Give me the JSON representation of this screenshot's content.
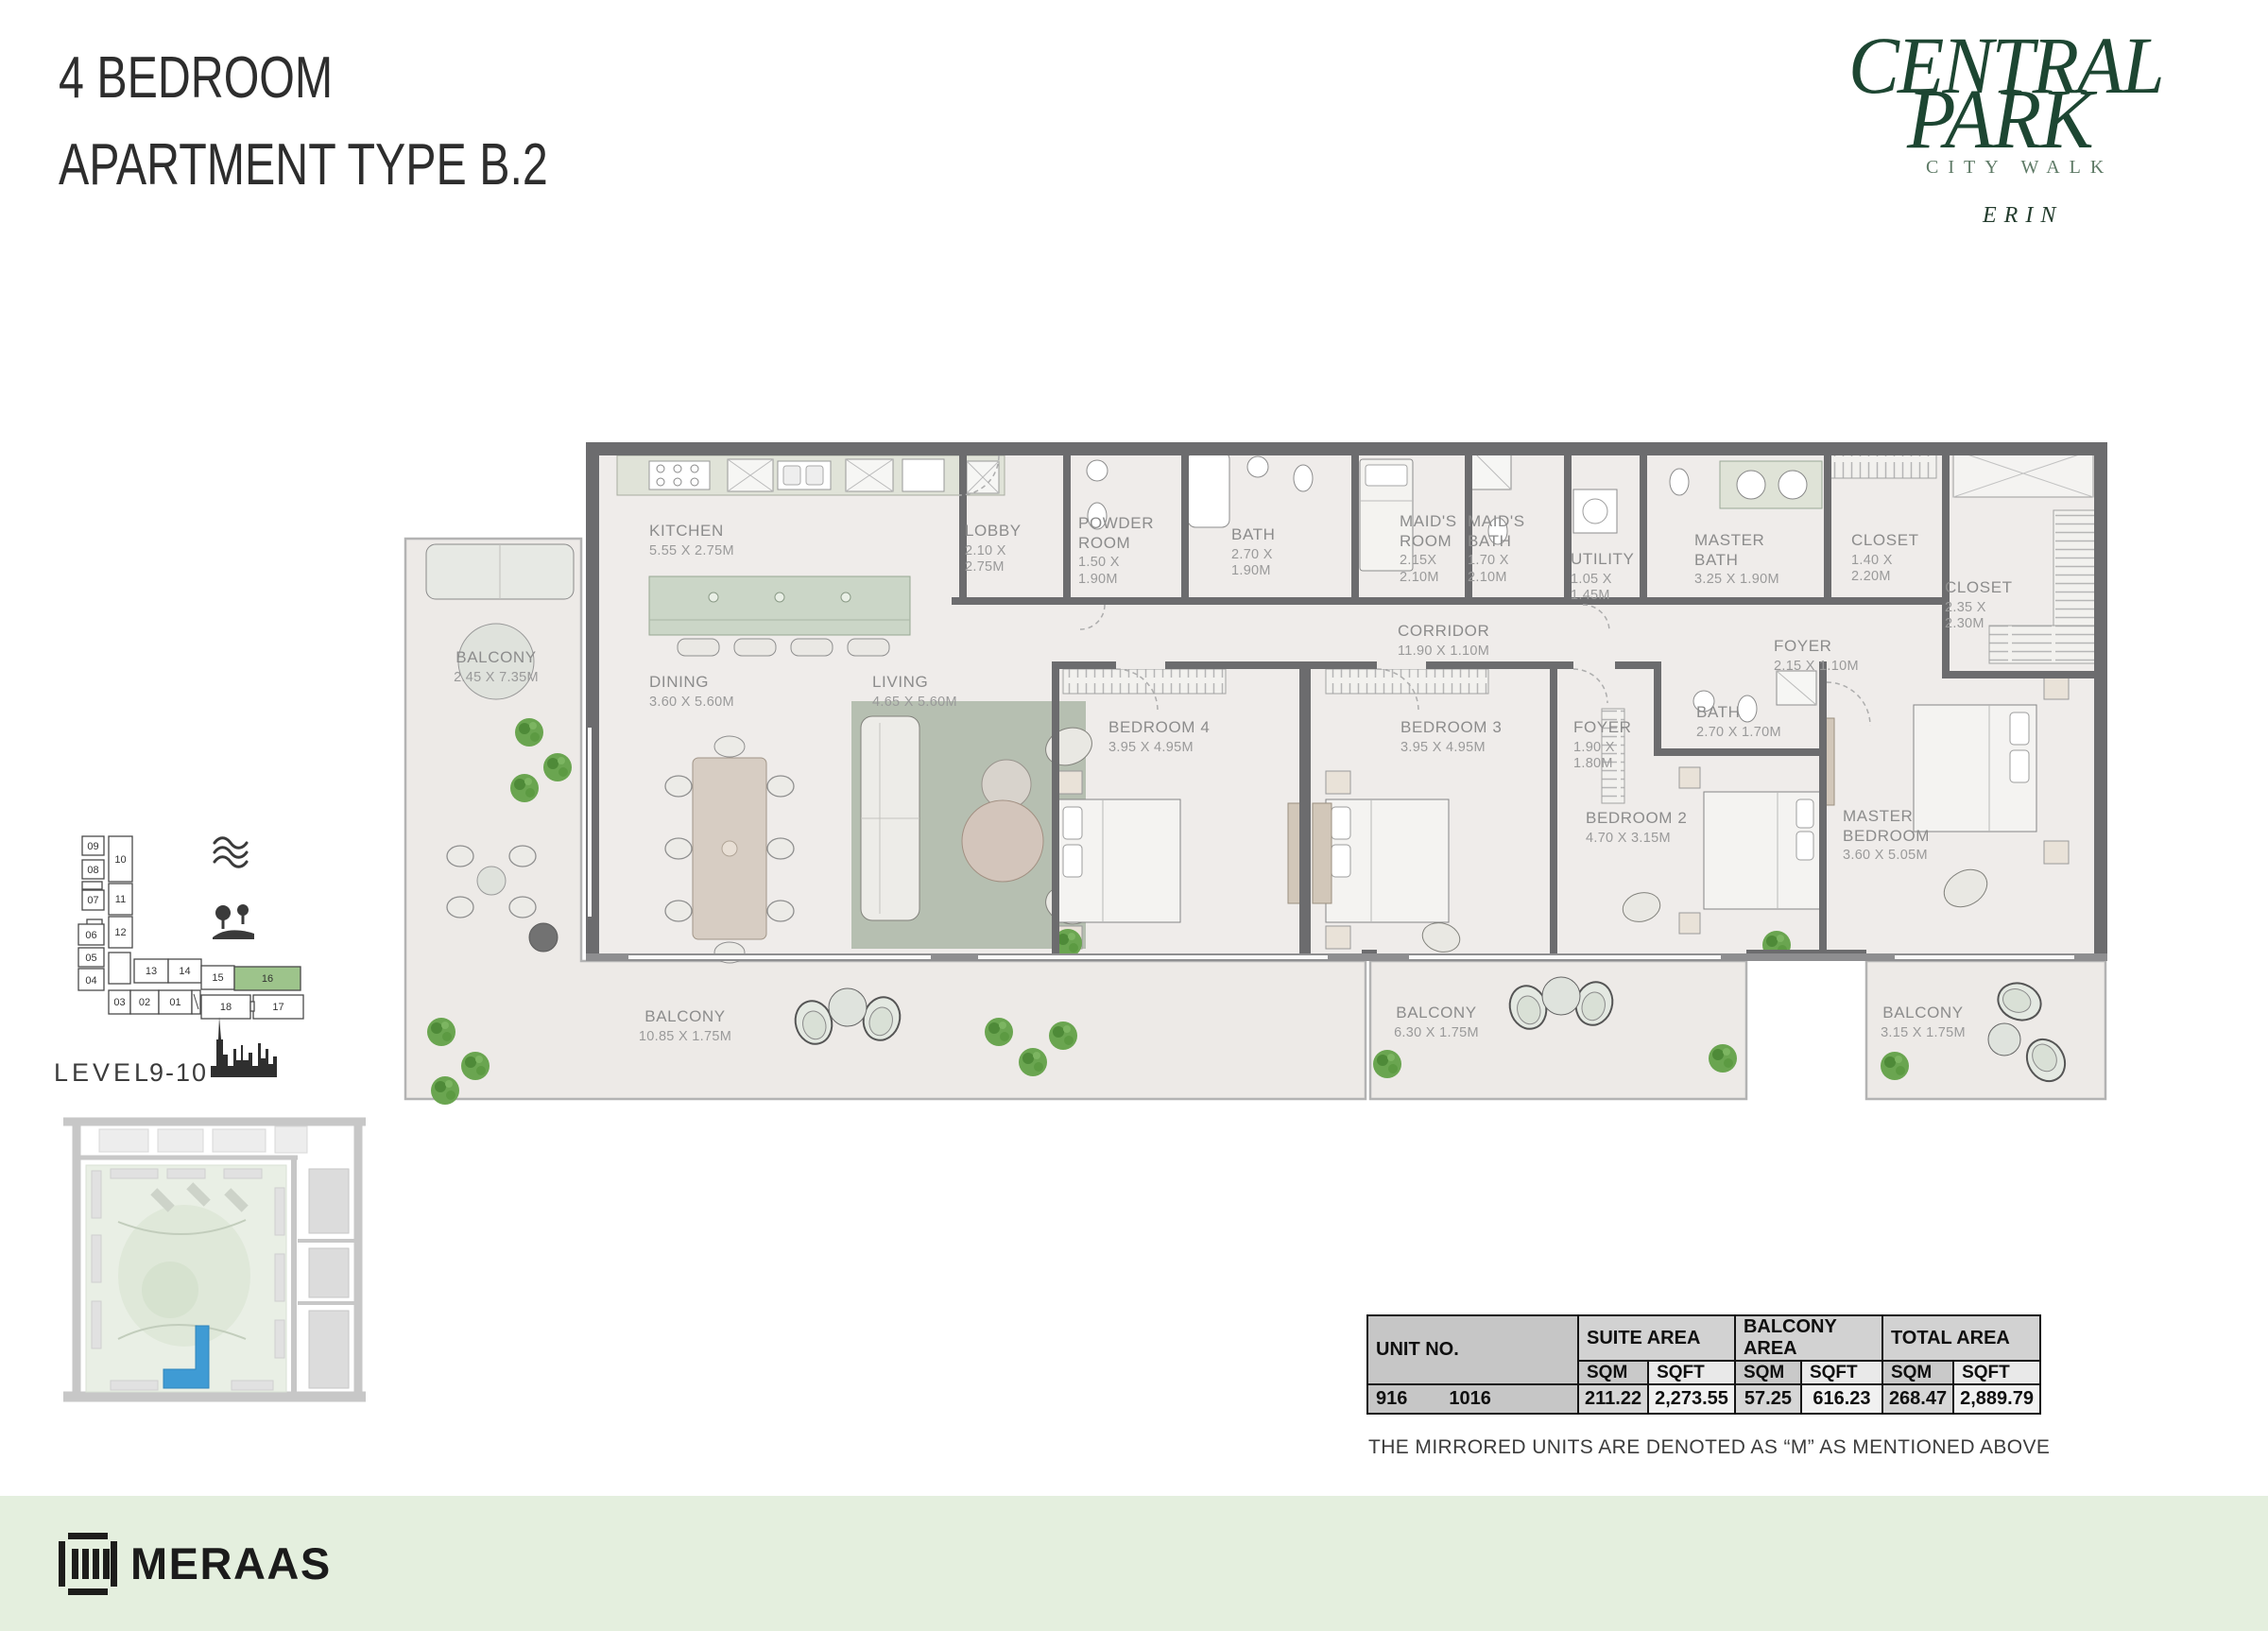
{
  "header": {
    "title_line1": "4 BEDROOM",
    "title_line2": "APARTMENT TYPE B.2"
  },
  "brand": {
    "name_line1": "CENTRAL",
    "name_line2": "PARK",
    "tagline": "CITY WALK",
    "collection": "ERIN",
    "accent_color": "#1d4632"
  },
  "keyplan": {
    "level_label": "LEVEL",
    "level_value": "9-10",
    "highlighted_unit": "16",
    "highlight_color": "#9dc48b",
    "units": {
      "u09": "09",
      "u10": "10",
      "u08": "08",
      "u07": "07",
      "u11": "11",
      "u06": "06",
      "u12": "12",
      "u05": "05",
      "u04": "04",
      "u13": "13",
      "u14": "14",
      "u15": "15",
      "u16": "16",
      "u03": "03",
      "u02": "02",
      "u01": "01",
      "u18": "18",
      "u17": "17"
    }
  },
  "rooms": {
    "kitchen": {
      "name": "KITCHEN",
      "dims": "5.55 X 2.75M"
    },
    "lobby": {
      "name": "LOBBY",
      "dims": "2.10 X\n2.75M"
    },
    "powder": {
      "name": "POWDER\nROOM",
      "dims": "1.50 X\n1.90M"
    },
    "bath_top": {
      "name": "BATH",
      "dims": "2.70 X\n1.90M"
    },
    "maids_room": {
      "name": "MAID'S\nROOM",
      "dims": "2.15X\n2.10M"
    },
    "maids_bath": {
      "name": "MAID'S\nBATH",
      "dims": "1.70 X\n2.10M"
    },
    "utility": {
      "name": "UTILITY",
      "dims": "1.05 X\n1.45M"
    },
    "master_bath": {
      "name": "MASTER\nBATH",
      "dims": "3.25 X 1.90M"
    },
    "closet_1": {
      "name": "CLOSET",
      "dims": "1.40 X\n2.20M"
    },
    "closet_2": {
      "name": "CLOSET",
      "dims": "2.35 X\n2.30M"
    },
    "corridor": {
      "name": "CORRIDOR",
      "dims": "11.90 X 1.10M"
    },
    "foyer_entry": {
      "name": "FOYER",
      "dims": "2.15 X 1.10M"
    },
    "dining": {
      "name": "DINING",
      "dims": "3.60 X 5.60M"
    },
    "living": {
      "name": "LIVING",
      "dims": "4.65 X 5.60M"
    },
    "bedroom_4": {
      "name": "BEDROOM 4",
      "dims": "3.95 X 4.95M"
    },
    "bedroom_3": {
      "name": "BEDROOM 3",
      "dims": "3.95 X 4.95M"
    },
    "foyer_bedrooms": {
      "name": "FOYER",
      "dims": "1.90 X\n1.80M"
    },
    "bath_bedrooms": {
      "name": "BATH",
      "dims": "2.70 X 1.70M"
    },
    "bedroom_2": {
      "name": "BEDROOM 2",
      "dims": "4.70 X 3.15M"
    },
    "master_bedroom": {
      "name": "MASTER\nBEDROOM",
      "dims": "3.60 X 5.05M"
    },
    "balcony_left": {
      "name": "BALCONY",
      "dims": "2.45 X 7.35M"
    },
    "balcony_main": {
      "name": "BALCONY",
      "dims": "10.85 X 1.75M"
    },
    "balcony_center": {
      "name": "BALCONY",
      "dims": "6.30 X 1.75M"
    },
    "balcony_master": {
      "name": "BALCONY",
      "dims": "3.15 X 1.75M"
    }
  },
  "area_table": {
    "headers": {
      "unit": "UNIT NO.",
      "suite": "SUITE AREA",
      "balcony": "BALCONY AREA",
      "total": "TOTAL AREA",
      "sqm": "SQM",
      "sqft": "SQFT"
    },
    "row": {
      "unit_a": "916",
      "unit_b": "1016",
      "suite_sqm": "211.22",
      "suite_sqft": "2,273.55",
      "balcony_sqm": "57.25",
      "balcony_sqft": "616.23",
      "total_sqm": "268.47",
      "total_sqft": "2,889.79"
    }
  },
  "note": {
    "text": "THE MIRRORED UNITS ARE DENOTED AS “M” AS MENTIONED ABOVE"
  },
  "footer": {
    "brand": "MERAAS"
  }
}
